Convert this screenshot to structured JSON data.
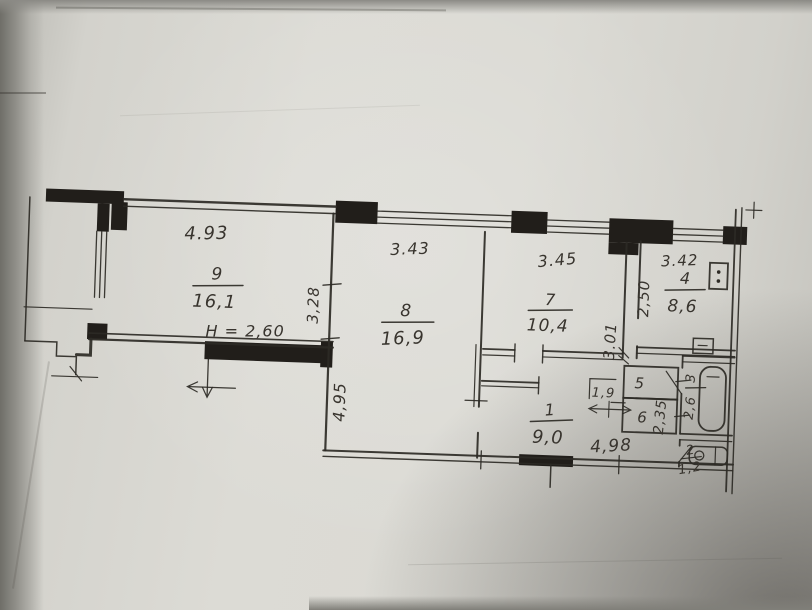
{
  "plan": {
    "height_note": "H = 2,60",
    "rooms": {
      "room9": {
        "number": "9",
        "area": "16,1"
      },
      "room8": {
        "number": "8",
        "area": "16,9"
      },
      "room7": {
        "number": "7",
        "area": "10,4"
      },
      "room4": {
        "number": "4",
        "area": "8,6"
      },
      "room1": {
        "number": "1",
        "area": "9,0"
      },
      "room5": {
        "number": "5"
      },
      "room6": {
        "number": "6"
      },
      "room3": {
        "number": "3",
        "area": "2,6"
      },
      "room2": {
        "number": "2",
        "area": "1,2"
      }
    },
    "dimensions": {
      "room9_width": "4.93",
      "room8_width": "3.43",
      "room7_width": "3.45",
      "room4_width": "3.42",
      "room9_depth": "3,28",
      "room8_depth": "4,95",
      "hall_depth": "3.01",
      "room4_depth": "2,50",
      "bath_depth": "2,35",
      "closet_width": "1,9",
      "hall_width": "4,98"
    },
    "colors": {
      "paper": "#dbdad4",
      "ink": "#2d2a25"
    }
  }
}
